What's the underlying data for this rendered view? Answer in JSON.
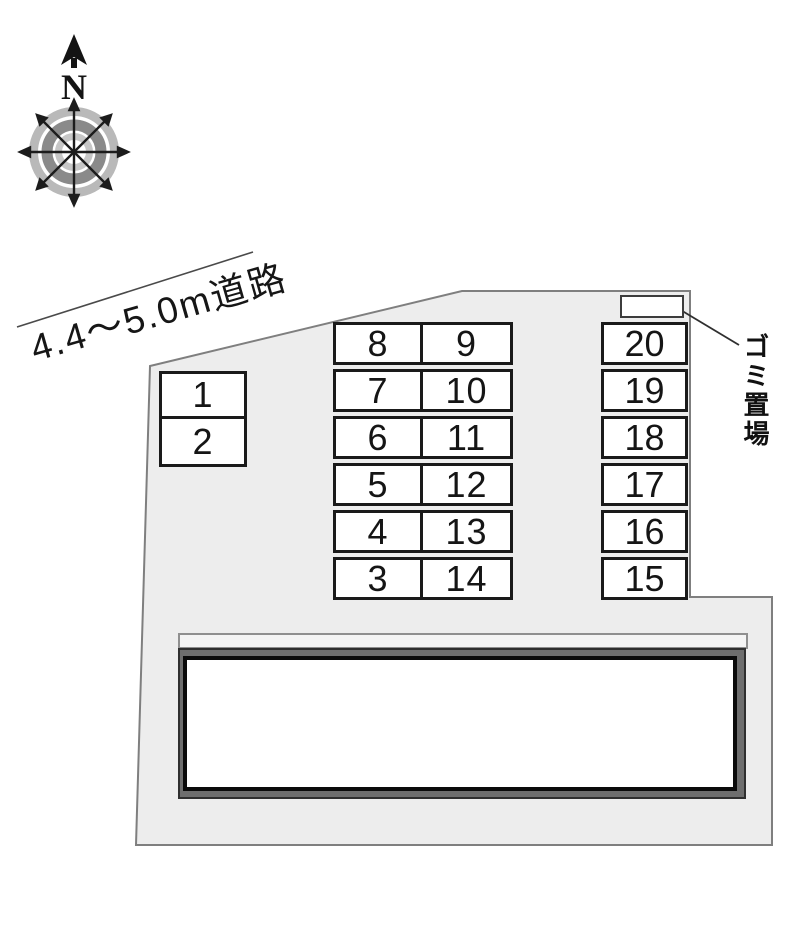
{
  "compass": {
    "north_label": "N"
  },
  "road": {
    "label": "4.4～5.0m道路"
  },
  "site": {
    "garbage_label": "ゴミ置場"
  },
  "parking": {
    "block_small": [
      "1",
      "2"
    ],
    "block_mid_left": [
      "8",
      "7",
      "6",
      "5",
      "4",
      "3"
    ],
    "block_mid_right": [
      "9",
      "10",
      "11",
      "12",
      "13",
      "14"
    ],
    "block_right": [
      "20",
      "19",
      "18",
      "17",
      "16",
      "15"
    ]
  },
  "colors": {
    "site_fill": "#ededed",
    "site_outline": "#7f7f7f",
    "cell_border": "#1a1a1a",
    "building_band": "#6e6e6e",
    "building_border": "#0b0b0b",
    "compass_ring_light": "#b9b9b9",
    "compass_ring_dark": "#8a8a8a",
    "text": "#111111"
  }
}
